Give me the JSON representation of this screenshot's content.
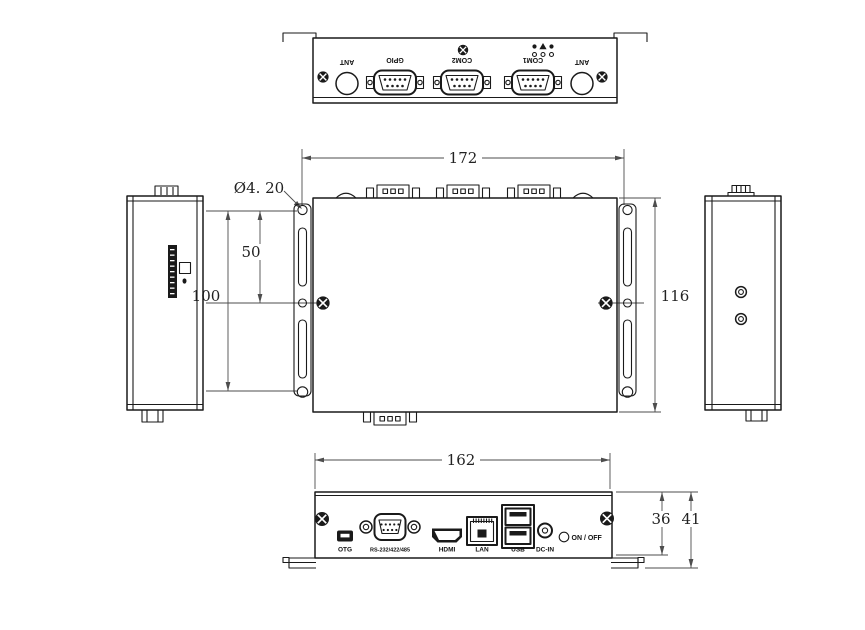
{
  "drawing": {
    "type": "mechanical-dimension-drawing"
  },
  "rear": {
    "ant_left": "ANT",
    "gpio": "GPIO",
    "com2": "COM2",
    "com1": "COM1",
    "ant_right": "ANT"
  },
  "front": {
    "otg": "OTG",
    "serial": "RS-232/422/485",
    "hdmi": "HDMI",
    "lan": "LAN",
    "usb": "USB",
    "dcin": "DC-IN",
    "power": "ON / OFF"
  },
  "dim": {
    "top_width": "172",
    "body_height": "116",
    "mount_span": "100",
    "mount_half": "50",
    "hole_diameter": "Ø4. 20",
    "front_width": "162",
    "panel_height": "36",
    "overall_height": "41"
  },
  "colors": {
    "line": "#1a1a1a",
    "dimension": "#4d4d4d",
    "background": "#ffffff"
  }
}
